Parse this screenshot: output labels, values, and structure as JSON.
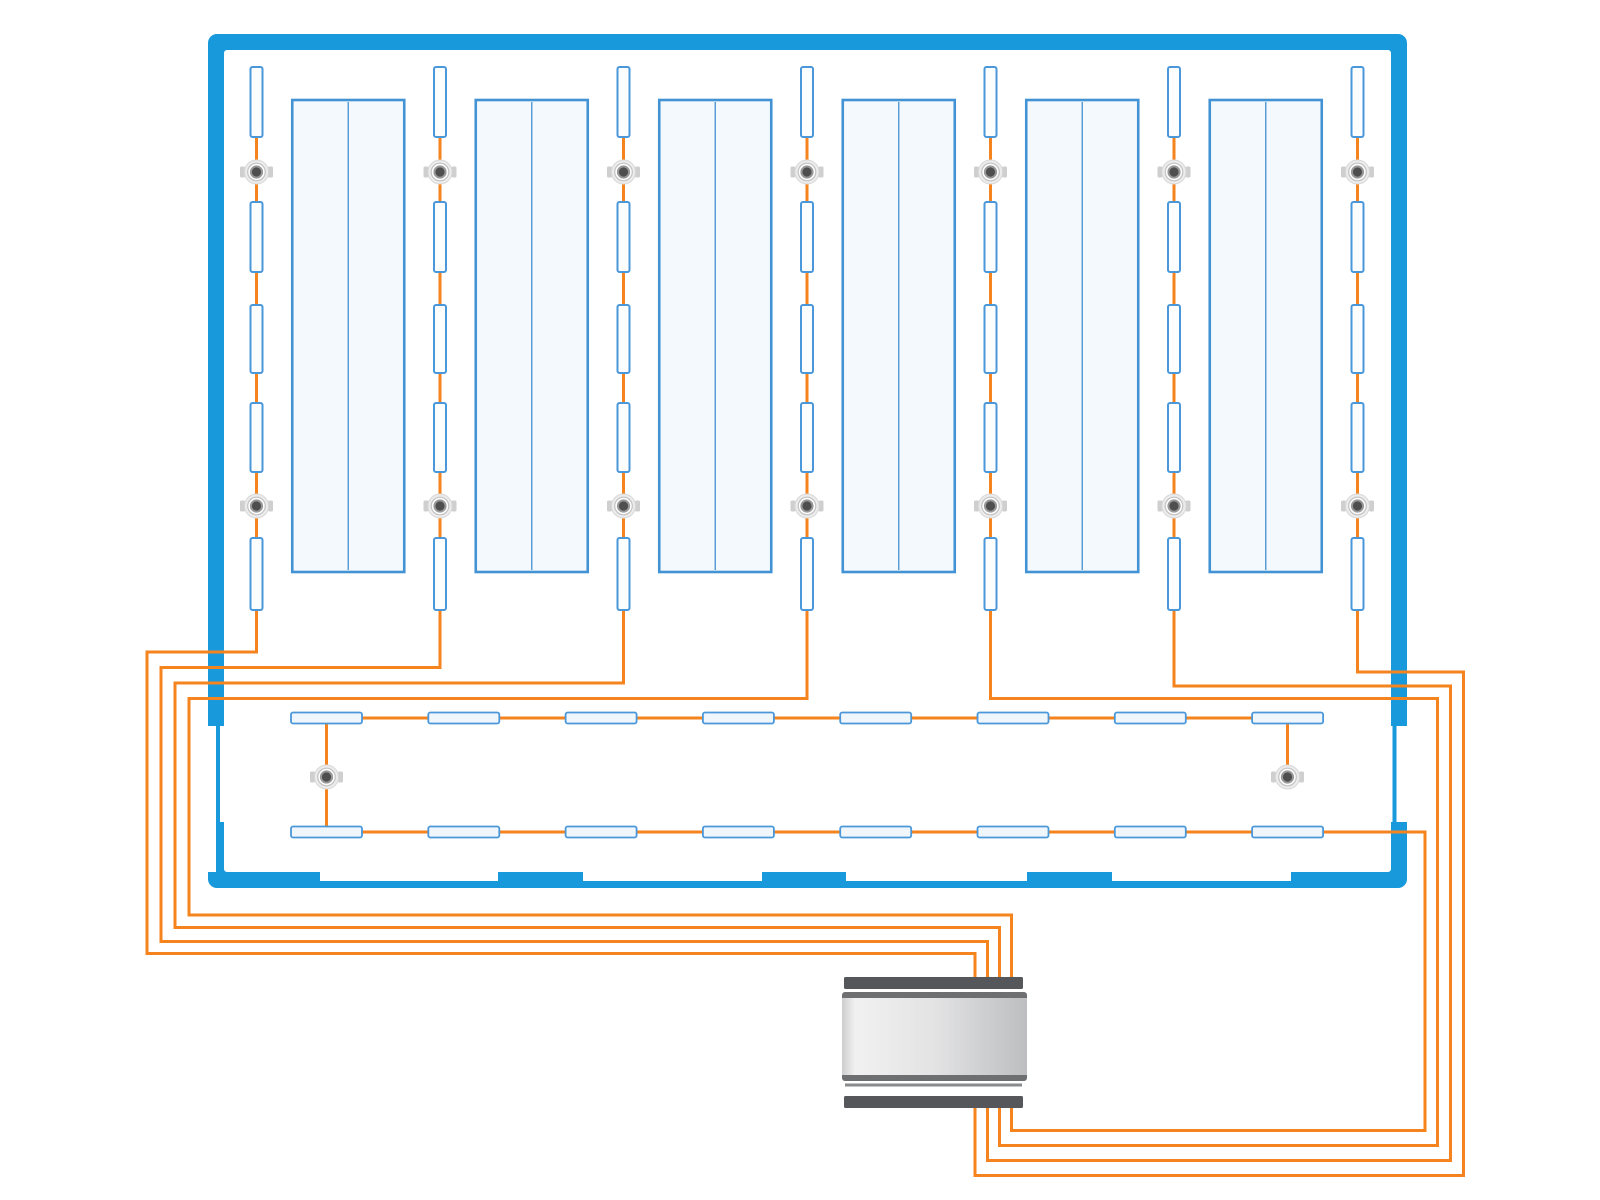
{
  "canvas": {
    "width": 1600,
    "height": 1200,
    "background": "#ffffff"
  },
  "colors": {
    "wall": "#1899dc",
    "panel_fill": "#f3f9fd",
    "panel_border": "#4292d4",
    "panel_divider": "#5097d3",
    "luminaire_fill": "#fbfdff",
    "luminaire_border": "#4a97d9",
    "corridor_luminaire_fill": "#f0f7fc",
    "wire": "#f5831e",
    "sensor_tab": "#cfcfcf",
    "sensor_disc": "#ececec",
    "sensor_disc_border": "#d8d8d8",
    "sensor_ring_fill": "#fdfdfd",
    "sensor_ring_border": "#c2c2c2",
    "sensor_dot": "#4e4e4e",
    "sensor_dot_border": "#989898",
    "controller_bar": "#56575a",
    "controller_edge": "#6e6f71",
    "controller_separator": "#898a8c",
    "controller_body_stops": [
      [
        "0%",
        "#cdcdce"
      ],
      [
        "7%",
        "#f1f1f2"
      ],
      [
        "50%",
        "#e3e3e4"
      ],
      [
        "100%",
        "#bdbec0"
      ]
    ]
  },
  "room": {
    "outer": [
      208,
      34,
      1199,
      854
    ],
    "thickness": 16,
    "radius_outer": 9,
    "radius_inner": 3,
    "cutouts": [
      [
        206,
        726,
        19,
        96
      ],
      [
        1389,
        726,
        19.5,
        96
      ],
      [
        206,
        822,
        10,
        50
      ],
      [
        320,
        871,
        178,
        10
      ],
      [
        583,
        871,
        179,
        10
      ],
      [
        846,
        871,
        181,
        10
      ],
      [
        1112,
        871,
        179,
        10
      ]
    ],
    "gap_lines": [
      [
        216,
        726,
        4,
        96
      ],
      [
        1392.5,
        726,
        4,
        96
      ]
    ]
  },
  "columns": {
    "centers_x": [
      256.5,
      440,
      623.5,
      807,
      990.5,
      1174,
      1357.5
    ],
    "luminaire_y_spans": [
      [
        67,
        137
      ],
      [
        202,
        272
      ],
      [
        305,
        373
      ],
      [
        403,
        472
      ],
      [
        538,
        610
      ]
    ],
    "luminaire_width": 12,
    "sensor_y": [
      172,
      506
    ]
  },
  "panels": {
    "y_top": 100,
    "height": 472,
    "width": 112
  },
  "corridor": {
    "row_y": [
      718,
      832
    ],
    "lum_x_first": 291,
    "lum_pitch": 137.3,
    "lum_count": 8,
    "lum_width": 71,
    "lum_height": 11,
    "sensors": [
      {
        "x": 326.5,
        "y": 777
      },
      {
        "x": 1287.5,
        "y": 777
      }
    ]
  },
  "wires": {
    "stroke_width": 3,
    "routes": [
      {
        "id": "run-column-1",
        "d": "M 256.5 137 V 652 H 147 V 953.5 H 975 V 988"
      },
      {
        "id": "run-column-2",
        "d": "M 440 137 V 667.5 H 161 V 941.5 H 987.5 V 988"
      },
      {
        "id": "run-column-3",
        "d": "M 623.5 137 V 683 H 175 V 927.5 H 999.5 V 988"
      },
      {
        "id": "run-column-4",
        "d": "M 807 137 V 698.5 H 189 V 915 H 1011.5 V 988"
      },
      {
        "id": "run-column-5",
        "d": "M 990.5 137 V 698.5 H 1437.5 V 1145.5 H 999.5 V 1100"
      },
      {
        "id": "run-column-6",
        "d": "M 1174 137 V 686 H 1450.5 V 1160.5 H 987.5 V 1100"
      },
      {
        "id": "run-column-7",
        "d": "M 1357.5 137 V 672 H 1463.5 V 1175.5 H 975 V 1100"
      },
      {
        "id": "run-corridor",
        "d": "M 1287.5 777 V 718 H 326.5 V 832 H 1425 V 1130.5 H 1011.5 V 1100"
      }
    ]
  },
  "sensor_geometry": {
    "disc_r": 12,
    "ring_r": 8.8,
    "dot_r": 5.6,
    "tab_w": 5,
    "tab_h": 11,
    "tab_offset": 16.5
  },
  "controller": {
    "top_bar": [
      844,
      977,
      179,
      12
    ],
    "bottom_bar": [
      844,
      1096,
      179,
      12
    ],
    "body_base": [
      842,
      992,
      185,
      89
    ],
    "body_inner": [
      842,
      998,
      185,
      77
    ],
    "separator": [
      845,
      1083.5,
      177,
      3
    ]
  }
}
